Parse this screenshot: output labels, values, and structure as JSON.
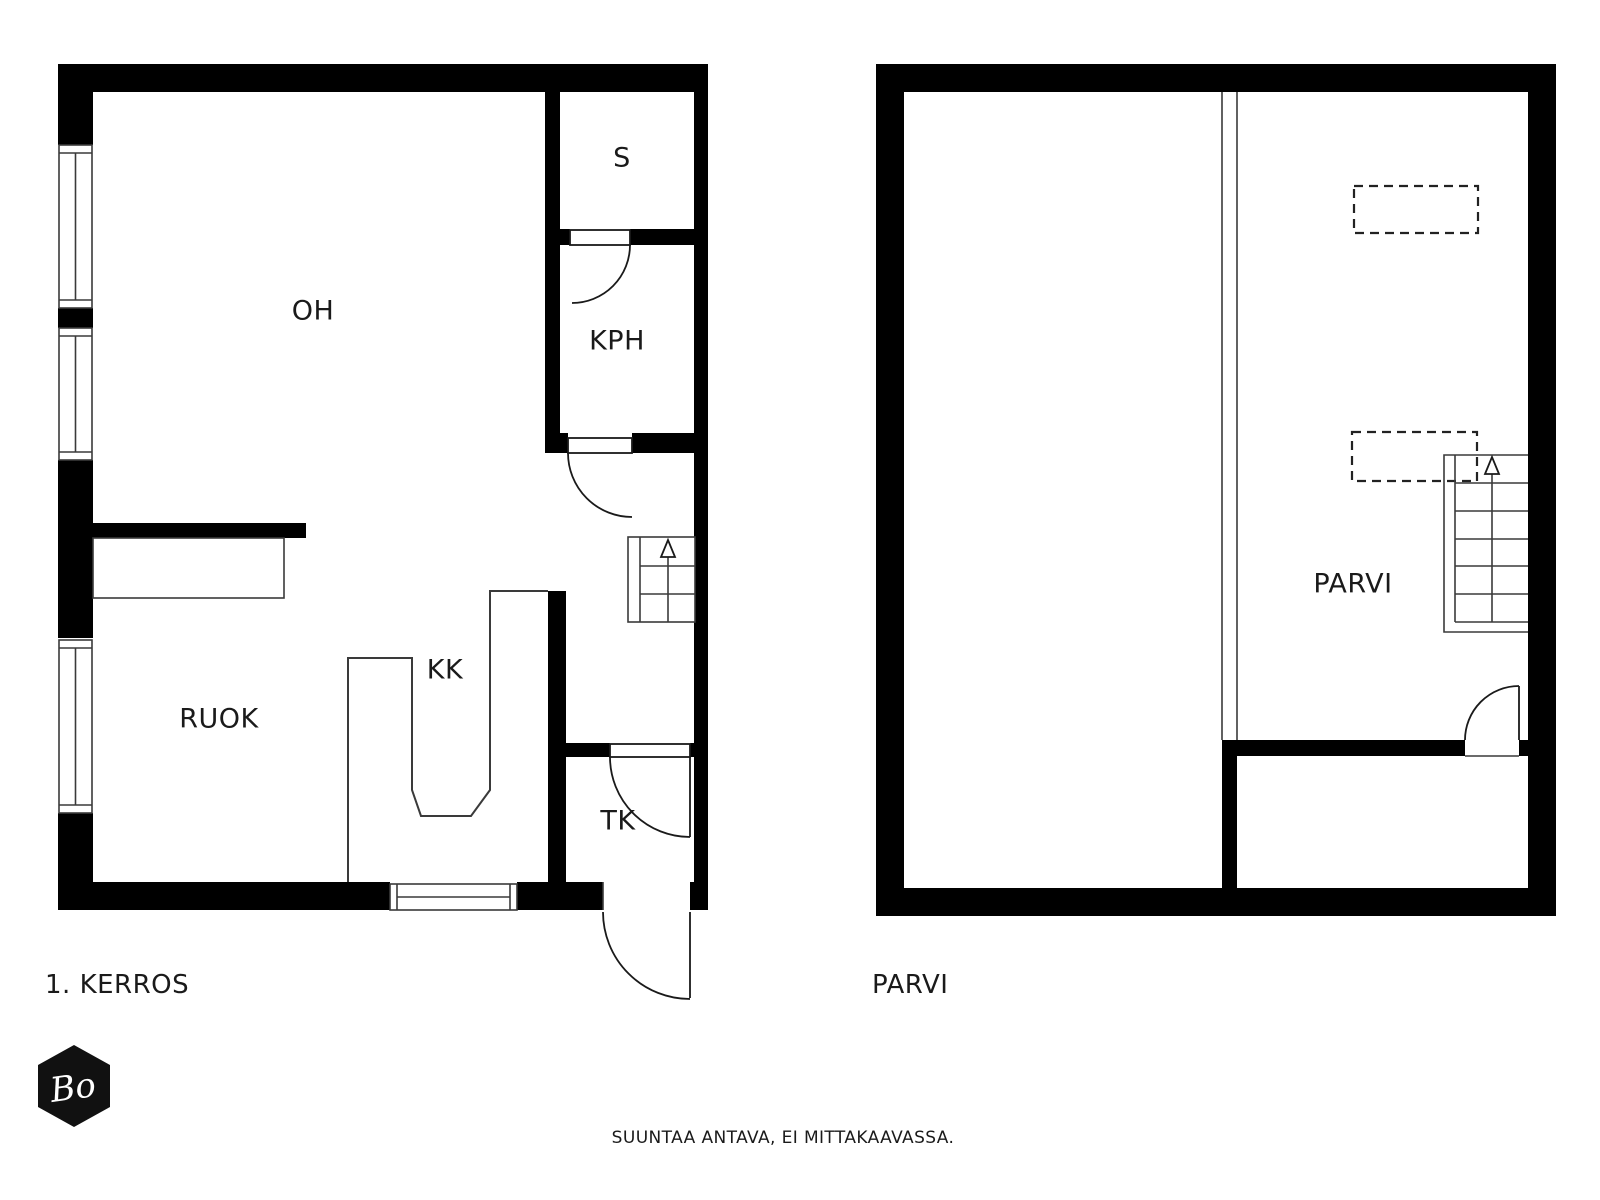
{
  "floor1": {
    "caption": "1. KERROS",
    "rooms": {
      "living": "OH",
      "sauna": "S",
      "bathroom": "KPH",
      "kitchenette": "KK",
      "dining": "RUOK",
      "entry": "TK"
    }
  },
  "loft": {
    "caption": "PARVI",
    "rooms": {
      "loft": "PARVI"
    }
  },
  "footer": {
    "disclaimer": "SUUNTAA ANTAVA, EI MITTAKAAVASSA."
  },
  "logo": {
    "text": "Bo"
  },
  "icons": {
    "stairs_direction": "up-arrow"
  },
  "colors": {
    "wall": "#000000",
    "line": "#3a3a3a",
    "text": "#1a1a1a",
    "background": "#ffffff"
  }
}
